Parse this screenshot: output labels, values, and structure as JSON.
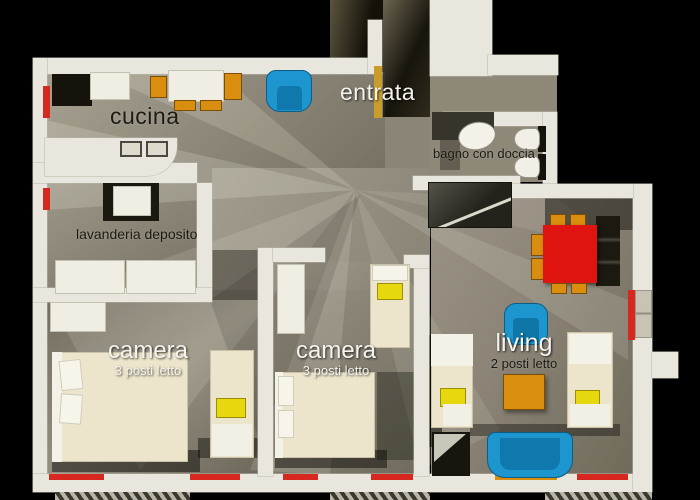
{
  "plan": {
    "view": "3d-top-down apartment floor plan",
    "rooms": [
      {
        "id": "cucina",
        "label": "cucina",
        "sublabel": ""
      },
      {
        "id": "entrata",
        "label": "entrata",
        "sublabel": ""
      },
      {
        "id": "bagno",
        "label": "bagno con doccia",
        "sublabel": ""
      },
      {
        "id": "lavanderia",
        "label": "lavanderia deposito",
        "sublabel": ""
      },
      {
        "id": "camera-1",
        "label": "camera",
        "sublabel": "3 posti letto"
      },
      {
        "id": "camera-2",
        "label": "camera",
        "sublabel": "3 posti letto"
      },
      {
        "id": "living",
        "label": "living",
        "sublabel": "2 posti letto"
      }
    ],
    "furniture": [
      "kitchen-table",
      "kitchen-chairs",
      "fridge",
      "kitchen-counter-sinks",
      "entry-armchair",
      "bathroom-sink",
      "toilet",
      "bidet",
      "shower",
      "laundry-appliance",
      "wardrobe",
      "double-bed",
      "single-bed",
      "dining-table",
      "dining-chairs",
      "lounge-armchair",
      "coffee-table",
      "sofa",
      "sofa-bed",
      "radiator",
      "balcony-deck"
    ],
    "colors": {
      "background": "#000000",
      "wall": "#e9e7dd",
      "floor": "#8b8577",
      "bed_cream": "#ece5cc",
      "furniture_blue": "#1d96cf",
      "furniture_red": "#df1410",
      "furniture_orange": "#d98e10",
      "pillow_yellow": "#e6d70e",
      "radiator_red": "#d6281e"
    }
  }
}
